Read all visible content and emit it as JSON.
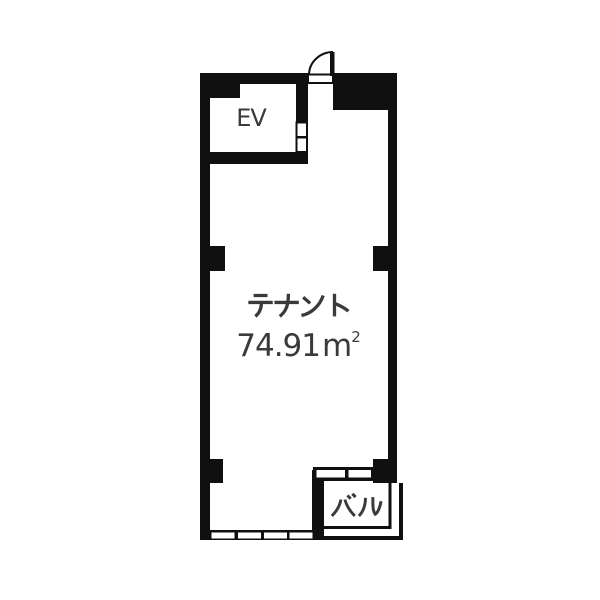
{
  "colors": {
    "wall": "#101010",
    "background": "#ffffff",
    "text": "#3a3a3a"
  },
  "rooms": {
    "elevator": {
      "label": "EV"
    },
    "tenant": {
      "label": "テナント",
      "area_value": "74.91",
      "area_unit": "m",
      "area_exponent": "2",
      "area_text": "74.91㎡"
    },
    "balcony": {
      "label": "バル"
    }
  },
  "fixtures": {
    "entrance_door": "swing-door",
    "elevator_door_panels": 2,
    "south_window_panes": 4,
    "balcony_window_panes": 2
  }
}
